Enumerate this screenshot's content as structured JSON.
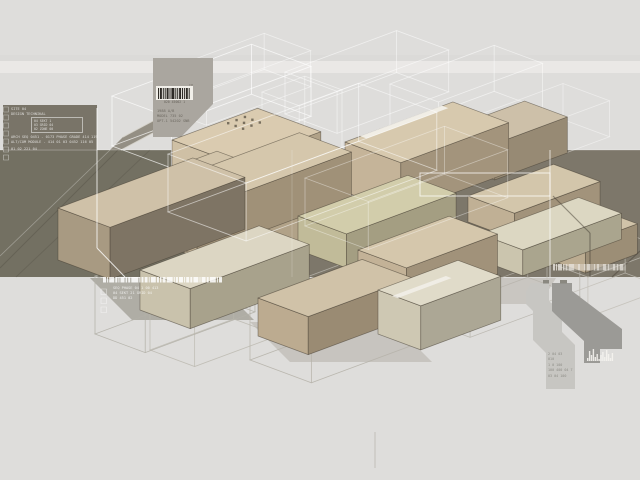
{
  "meta": {
    "description": "axonometric architectural massing study render"
  },
  "colors": {
    "background": "#dedddb",
    "band_left": "#737062",
    "band_right": "#7d776a",
    "left_panel": "#797468",
    "barcode_panel": "#aaa69f",
    "block_top": "#d5c7ac",
    "block_pale": "#dcd7c3",
    "wireframe_white": "#ffffff",
    "wireframe_gray": "#b6b3aa"
  },
  "text": {
    "tm": "TM",
    "top_panel": {
      "caption": "020 45002 1",
      "l1": "1988 A/B",
      "l2": "MODEL 735 02",
      "l3": "OPT-1 54202 SNB"
    },
    "left_panel": {
      "h1": "SITE 04",
      "h2": "DESIGN TECHNIKAL",
      "box_rows": [
        "04 SEKT 1",
        "03 GRID 04",
        "02 ZONE 00"
      ],
      "l1": "ARCH SEQ 0451 - 0173 PHASE GRADE 414 119",
      "l2": "ALT/COM MODULE - 414 01 03 0452 116 05",
      "l3": "01 02 221 04"
    },
    "band_bottom": {
      "rows": [
        "SEQ PHASE 04 1 00 413",
        "04 SEKT 21 GRID 04",
        "DD 451 02"
      ]
    },
    "bottom_right": {
      "rows": [
        "2 04 03",
        "010",
        "1 0 100",
        "100 400 04 7",
        "03 04 100"
      ]
    }
  },
  "scene": {
    "edge": "rgba(66,59,48,0.55)",
    "iso_u": [
      0.93,
      -0.345
    ],
    "iso_v": [
      0.93,
      0.345
    ],
    "layers": [
      {
        "type": "rect",
        "items": [
          {
            "x": 0,
            "y": 55,
            "w": 640,
            "h": 6,
            "fill": "#d9d8d6",
            "opacity": 0.6
          },
          {
            "x": 0,
            "y": 61,
            "w": 640,
            "h": 12,
            "fill": "#ecebe9",
            "opacity": 0.8
          }
        ]
      },
      {
        "type": "rect",
        "items": [
          {
            "x": 0,
            "y": 150,
            "w": 292,
            "h": 127,
            "fill": "#737062"
          },
          {
            "x": 292,
            "y": 150,
            "w": 348,
            "h": 127,
            "fill": "#7d776a"
          },
          {
            "x": 3,
            "y": 105,
            "w": 94,
            "h": 46,
            "fill": "#797468"
          }
        ]
      },
      {
        "type": "poly",
        "items": [
          {
            "points": "179,107 153,133 121,150 110,150 123,137",
            "fill": "#8f8a80",
            "opacity": 0.95
          }
        ]
      },
      {
        "type": "line",
        "items": [
          [
            179,
            107,
            123,
            137,
            "#d8d5cd",
            0.9,
            1
          ],
          [
            153,
            133,
            121,
            150,
            "#d8d5cd",
            0.9,
            1
          ],
          [
            0,
            268,
            118,
            150,
            "#3f3a31",
            0.25,
            1
          ],
          [
            16,
            277,
            150,
            150,
            "#3f3a31",
            0.2,
            1
          ],
          [
            0,
            256,
            110,
            150,
            "#ffffff",
            0.3,
            0.8
          ],
          [
            0,
            150,
            640,
            150,
            "#ffffff",
            0.3,
            0.8
          ]
        ]
      },
      {
        "type": "wire",
        "items": [
          {
            "x": 112,
            "y": 96,
            "a": 150,
            "b": 64,
            "h": 50,
            "c": "#ffffff",
            "o": 0.7,
            "w": 0.9
          },
          {
            "x": 160,
            "y": 72,
            "a": 112,
            "b": 50,
            "h": 36,
            "c": "#ffffff",
            "o": 0.5,
            "w": 0.8
          },
          {
            "x": 285,
            "y": 72,
            "a": 120,
            "b": 56,
            "h": 42,
            "c": "#ffffff",
            "o": 0.55,
            "w": 0.8
          },
          {
            "x": 390,
            "y": 84,
            "a": 112,
            "b": 52,
            "h": 46,
            "c": "#ffffff",
            "o": 0.55,
            "w": 0.8
          },
          {
            "x": 470,
            "y": 118,
            "a": 100,
            "b": 50,
            "h": 36,
            "c": "#ffffff",
            "o": 0.45,
            "w": 0.8
          },
          {
            "x": 262,
            "y": 92,
            "a": 46,
            "b": 40,
            "h": 70,
            "c": "#ffffff",
            "o": 0.5,
            "w": 0.8
          }
        ]
      },
      {
        "type": "poly",
        "items": [
          {
            "points": "153,58 213,58 213,104 181,137 153,137",
            "fill": "#aaa69f"
          },
          {
            "points": "90,278 212,278 254,320 132,320",
            "fill": "#a7a49b",
            "opacity": 0.85
          },
          {
            "points": "250,322 392,322 432,362 290,362",
            "fill": "#b7b4ab",
            "opacity": 0.6
          },
          {
            "points": "432,278 556,278 540,304 452,304",
            "fill": "#b3b0a7",
            "opacity": 0.5
          }
        ]
      },
      {
        "type": "wire",
        "items": [
          {
            "x": 95,
            "y": 276,
            "a": 118,
            "b": 54,
            "h": 58,
            "c": "#b3b0a7",
            "o": 0.9
          },
          {
            "x": 250,
            "y": 298,
            "a": 150,
            "b": 66,
            "h": 62,
            "c": "#b6b3aa",
            "o": 0.9
          },
          {
            "x": 150,
            "y": 300,
            "a": 90,
            "b": 48,
            "h": 50,
            "c": "#b9b6ad",
            "o": 0.8
          },
          {
            "x": 418,
            "y": 270,
            "a": 118,
            "b": 56,
            "h": 48,
            "c": "#b6b3aa",
            "o": 0.85
          },
          {
            "x": 547,
            "y": 262,
            "a": 84,
            "b": 44,
            "h": 40,
            "c": "#c0bdb4",
            "o": 0.8
          }
        ]
      },
      {
        "type": "box",
        "items": [
          {
            "x": 452,
            "y": 128,
            "a": 78,
            "b": 46,
            "h": 36,
            "t": "#cdc0a9",
            "l": "#b4a58c",
            "r": "#978a74"
          },
          {
            "x": 345,
            "y": 142,
            "a": 116,
            "b": 60,
            "h": 50,
            "t": "#d7c9ae",
            "l": "#c5b499",
            "r": "#a3947c"
          },
          {
            "x": 172,
            "y": 140,
            "a": 92,
            "b": 68,
            "h": 108,
            "t": "#dacbb0",
            "l": "#cfc0a5",
            "r": "#b1a288"
          },
          {
            "x": 150,
            "y": 176,
            "a": 72,
            "b": 32,
            "h": 20,
            "t": "#d2c4aa",
            "l": "#bdae93",
            "r": "#9e9078"
          },
          {
            "x": 145,
            "y": 190,
            "a": 166,
            "b": 56,
            "h": 46,
            "t": "#d5c7ac",
            "l": "#c2b297",
            "r": "#a09178"
          },
          {
            "x": 58,
            "y": 208,
            "a": 145,
            "b": 56,
            "h": 52,
            "t": "#cfc1a8",
            "l": "#a89a82",
            "r": "#7e7464"
          },
          {
            "x": 468,
            "y": 196,
            "a": 92,
            "b": 50,
            "h": 26,
            "t": "#d3c6ab",
            "l": "#c0b095",
            "r": "#a2937b"
          },
          {
            "x": 550,
            "y": 230,
            "a": 56,
            "b": 38,
            "h": 30,
            "t": "#d0c3a9",
            "l": "#bcac91",
            "r": "#9c8e76"
          },
          {
            "x": 298,
            "y": 216,
            "a": 118,
            "b": 52,
            "h": 34,
            "t": "#d2cdab",
            "l": "#c1bb99",
            "r": "#a49e82"
          },
          {
            "x": 480,
            "y": 234,
            "a": 106,
            "b": 46,
            "h": 26,
            "t": "#dcd7c2",
            "l": "#cbc5ae",
            "r": "#aaa58e"
          },
          {
            "x": 358,
            "y": 250,
            "a": 98,
            "b": 52,
            "h": 40,
            "t": "#d5c7ac",
            "l": "#c3b297",
            "r": "#a1927a"
          },
          {
            "x": 140,
            "y": 270,
            "a": 128,
            "b": 54,
            "h": 40,
            "t": "#dcd6c3",
            "l": "#c9c2ac",
            "r": "#a8a28c"
          },
          {
            "x": 258,
            "y": 298,
            "a": 112,
            "b": 54,
            "h": 38,
            "t": "#d0c2a8",
            "l": "#bcab90",
            "r": "#9a8b73"
          },
          {
            "x": 378,
            "y": 290,
            "a": 86,
            "b": 46,
            "h": 44,
            "t": "#e0dbc9",
            "l": "#cec8b3",
            "r": "#aca795"
          }
        ]
      },
      {
        "type": "poly",
        "items": [
          {
            "points": "360,136 441.8,105.6 448.3,108.1 366.5,138.5",
            "fill": "#f4f2ec",
            "opacity": 0.9
          },
          {
            "points": "392,296 445.9,276 451.5,278.1 397.6,298.1",
            "fill": "#f2f0ea",
            "opacity": 0.85
          }
        ]
      },
      {
        "type": "dots",
        "items": [
          {
            "x": 227,
            "y": 122,
            "rows": 3,
            "cols": 3,
            "su": 9,
            "sv": 8,
            "r": 1.2,
            "fill": "#5f584a",
            "o": 0.8
          }
        ]
      },
      {
        "type": "wire",
        "items": [
          {
            "x": 168,
            "y": 154,
            "a": 205,
            "b": 84,
            "h": 58,
            "c": "#ffffff",
            "o": 0.55,
            "w": 0.9
          },
          {
            "x": 305,
            "y": 178,
            "a": 150,
            "b": 68,
            "h": 48,
            "c": "#ffffff",
            "o": 0.4,
            "w": 0.8
          }
        ]
      },
      {
        "type": "line",
        "items": [
          [
            97,
            108,
            97,
            248,
            "#ffffff",
            0.8,
            1
          ],
          [
            97,
            248,
            125,
            277,
            "#ffffff",
            0.8,
            1
          ],
          [
            550,
            150,
            550,
            277,
            "#ffffff",
            0.7,
            1
          ],
          [
            292,
            150,
            292,
            277,
            "#ffffff",
            0.18,
            1
          ],
          [
            553,
            196,
            590,
            233,
            "#463f35",
            0.5,
            1.2
          ],
          [
            590,
            233,
            590,
            277,
            "#463f35",
            0.5,
            1.2
          ],
          [
            612,
            277,
            640,
            251,
            "#463f35",
            0.45,
            1.2
          ],
          [
            375,
            432,
            375,
            468,
            "#b8b5ac",
            0.7,
            1
          ]
        ]
      },
      {
        "type": "poly",
        "items": [
          {
            "points": "420,173 550,173 550,196 420,196",
            "fill": "none",
            "stroke": "rgba(255,255,255,0.75)",
            "sw": 1
          },
          {
            "points": "531,283 549,283 549,301 562,314 562,332 575,345 575,389 546,389 546,353 533,340 533,311 526,304 526,292",
            "fill": "#c7c6c2"
          },
          {
            "points": "552,283 572,283 572,291 622,329 622,349 600,349 600,363 584,363 584,341 556,315 552,311",
            "fill": "#9b9a96"
          }
        ]
      },
      {
        "type": "rect",
        "items": [
          {
            "x": 543,
            "y": 280,
            "w": 6,
            "h": 3.5,
            "fill": "#8a8880"
          },
          {
            "x": 560,
            "y": 280,
            "w": 7,
            "h": 3.5,
            "fill": "#8a8880"
          },
          {
            "x": 156,
            "y": 86,
            "w": 37,
            "h": 14,
            "fill": "#f1efe9"
          }
        ]
      },
      {
        "type": "barcode",
        "items": [
          {
            "x": 158,
            "y": 88,
            "h": 11,
            "gap": 0.9,
            "color": "#2e2b26",
            "o": 1,
            "bars": [
              1,
              2,
              1,
              1,
              2,
              1,
              3,
              1,
              1,
              2,
              1,
              1,
              2,
              1
            ]
          },
          {
            "x": 103,
            "y": 277,
            "h": 5.5,
            "gap": 1.1,
            "color": "#ffffff",
            "o": 0.85,
            "bars": [
              3,
              1,
              5,
              2,
              1,
              4,
              1.5,
              2,
              7,
              1,
              2,
              3,
              1,
              5,
              2,
              1.5,
              3,
              6,
              1,
              2,
              4,
              1,
              3,
              2,
              5,
              1,
              4,
              2,
              6,
              1,
              3
            ]
          },
          {
            "x": 553,
            "y": 264,
            "h": 6.5,
            "gap": 1,
            "color": "#e8e5de",
            "o": 0.8,
            "bars": [
              2,
              1,
              4,
              1.5,
              2,
              6,
              1,
              3,
              1,
              2,
              4,
              1,
              2,
              3,
              1,
              4,
              2,
              1,
              3,
              2,
              4,
              1
            ]
          }
        ]
      },
      {
        "type": "skyline",
        "items": [
          {
            "x": 587,
            "y": 361,
            "w": 1.4,
            "gap": 0.5,
            "fill": "#f5f3ee",
            "o": 0.9,
            "bars": [
              3,
              10,
              6,
              12,
              4,
              7,
              2,
              6,
              9,
              4,
              11,
              7,
              3,
              8
            ]
          }
        ]
      },
      {
        "type": "poly",
        "items": [
          {
            "points": "3.5,107 8.5,107 8.5,112 3.5,112",
            "fill": "none",
            "stroke": "rgba(255,255,255,0.5)",
            "sw": 0.6
          },
          {
            "points": "3.5,115 8.5,115 8.5,120 3.5,120",
            "fill": "none",
            "stroke": "rgba(255,255,255,0.5)",
            "sw": 0.6
          },
          {
            "points": "3.5,123 8.5,123 8.5,128 3.5,128",
            "fill": "none",
            "stroke": "rgba(255,255,255,0.5)",
            "sw": 0.6
          },
          {
            "points": "3.5,131 8.5,131 8.5,136 3.5,136",
            "fill": "none",
            "stroke": "rgba(255,255,255,0.5)",
            "sw": 0.6
          },
          {
            "points": "3.5,139 8.5,139 8.5,144 3.5,144",
            "fill": "none",
            "stroke": "rgba(255,255,255,0.5)",
            "sw": 0.6
          },
          {
            "points": "3.5,147 8.5,147 8.5,152 3.5,152",
            "fill": "none",
            "stroke": "rgba(255,255,255,0.55)",
            "sw": 0.6
          },
          {
            "points": "3.5,155 8.5,155 8.5,160 3.5,160",
            "fill": "none",
            "stroke": "rgba(255,255,255,0.55)",
            "sw": 0.6
          },
          {
            "points": "101,289 106.5,289 106.5,294.5 101,294.5",
            "fill": "none",
            "stroke": "rgba(255,255,255,0.6)",
            "sw": 0.6
          },
          {
            "points": "101,298 106.5,298 106.5,303.5 101,303.5",
            "fill": "none",
            "stroke": "rgba(255,255,255,0.6)",
            "sw": 0.6
          },
          {
            "points": "101,307 106.5,307 106.5,312.5 101,312.5",
            "fill": "none",
            "stroke": "rgba(255,255,255,0.6)",
            "sw": 0.6
          }
        ]
      }
    ]
  }
}
